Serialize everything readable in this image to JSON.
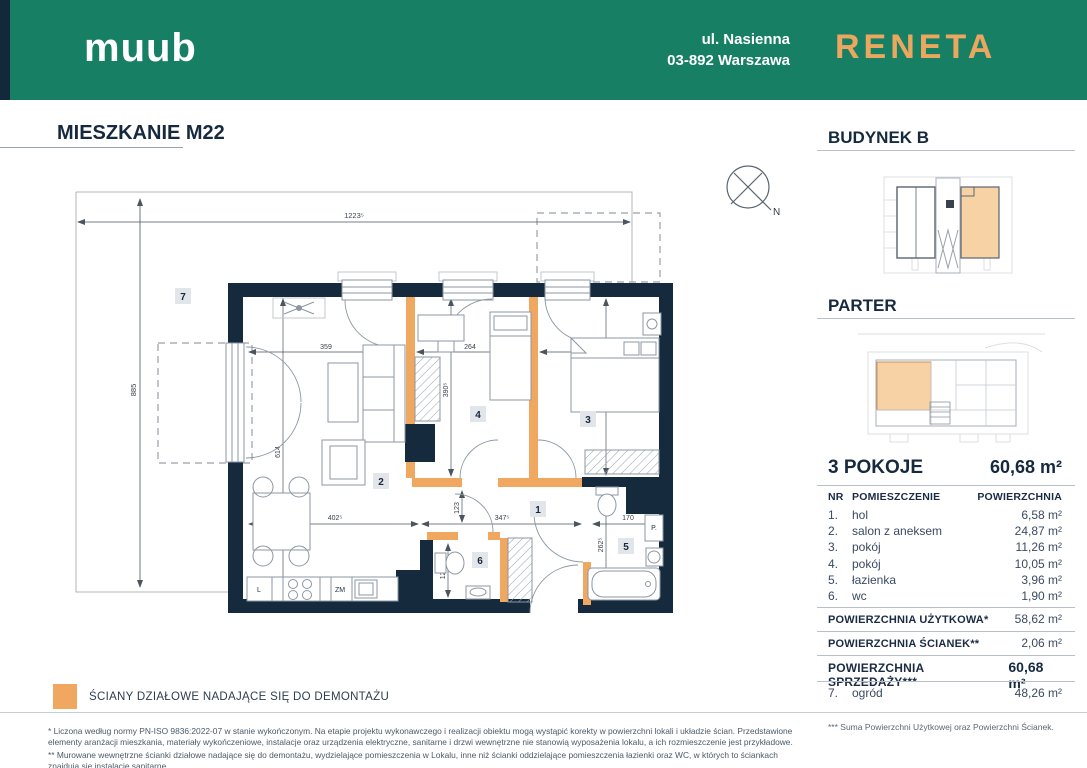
{
  "colors": {
    "header_green": "#177F64",
    "wall_dark_navy": "#152A3C",
    "partition_orange": "#F0A75F",
    "building_highlight": "#F7D2A4",
    "text_navy": "#16293E"
  },
  "header": {
    "brand_left": "MUUB",
    "address_line1": "ul. Nasienna",
    "address_line2": "03-892 Warszawa",
    "brand_right": "RENETA"
  },
  "plan": {
    "title": "MIESZKANIE M22",
    "compass_label": "N",
    "rooms": {
      "garden": "7",
      "salon": "2",
      "pokoj4": "4",
      "pokoj3": "3",
      "hol": "1",
      "wc": "6",
      "lazienka": "5"
    },
    "appliances": {
      "fridge": "L",
      "dishwasher": "ZM",
      "washer": "P."
    },
    "dims": {
      "total_w": "1223⁵",
      "total_h": "885",
      "salon_w": "359",
      "pokoj4_w": "264",
      "pokoj3_w": "284",
      "pokoj4_h": "390⁵",
      "pokoj3_h": "390⁵",
      "salon_h": "614",
      "kitchen_w": "402⁵",
      "hol_w": "347⁵",
      "bath_w": "170",
      "hol_h": "123",
      "bath_h": "262⁵",
      "wc_h": "128⁵"
    }
  },
  "sidebar": {
    "budynek_title": "BUDYNEK B",
    "parter_title": "PARTER",
    "summary": {
      "rooms_label": "3 POKOJE",
      "area": "60,68 m²"
    },
    "table": {
      "col_nr": "NR",
      "col_name": "POMIESZCZENIE",
      "col_area": "POWIERZCHNIA",
      "rows": [
        {
          "nr": "1.",
          "name": "hol",
          "area": "6,58 m²"
        },
        {
          "nr": "2.",
          "name": "salon z aneksem",
          "area": "24,87 m²"
        },
        {
          "nr": "3.",
          "name": "pokój",
          "area": "11,26 m²"
        },
        {
          "nr": "4.",
          "name": "pokój",
          "area": "10,05 m²"
        },
        {
          "nr": "5.",
          "name": "łazienka",
          "area": "3,96 m²"
        },
        {
          "nr": "6.",
          "name": "wc",
          "area": "1,90 m²"
        }
      ],
      "uzytkowa_label": "POWIERZCHNIA UŻYTKOWA*",
      "uzytkowa_value": "58,62 m²",
      "scianek_label": "POWIERZCHNIA ŚCIANEK**",
      "scianek_value": "2,06 m²",
      "sprzedazy_label": "POWIERZCHNIA SPRZEDAŻY***",
      "sprzedazy_value": "60,68 m²",
      "ogrod_nr": "7.",
      "ogrod_name": "ogród",
      "ogrod_value": "48,26 m²"
    },
    "footnote_right": "*** Suma Powierzchni Użytkowej oraz Powierzchni Ścianek."
  },
  "legend": {
    "label": "ŚCIANY DZIAŁOWE NADAJĄCE SIĘ DO DEMONTAŻU"
  },
  "footnotes": {
    "note1": "* Liczona według normy PN-ISO 9836:2022-07 w stanie wykończonym. Na etapie projektu wykonawczego i realizacji obiektu mogą wystąpić korekty w powierzchni lokali i układzie ścian. Przedstawione elementy aranżacji mieszkania, materiały wykończeniowe, instalacje oraz urządzenia elektryczne, sanitarne i drzwi wewnętrzne nie stanowią wyposażenia lokalu, a ich rozmieszczenie jest przykładowe.",
    "note2": "** Murowane wewnętrzne ścianki działowe nadające się do demontażu, wydzielające pomieszczenia w Lokalu, inne niż ścianki oddzielające pomieszczenia łazienki oraz WC, w których to ściankach znajdują się instalacje sanitarne."
  }
}
